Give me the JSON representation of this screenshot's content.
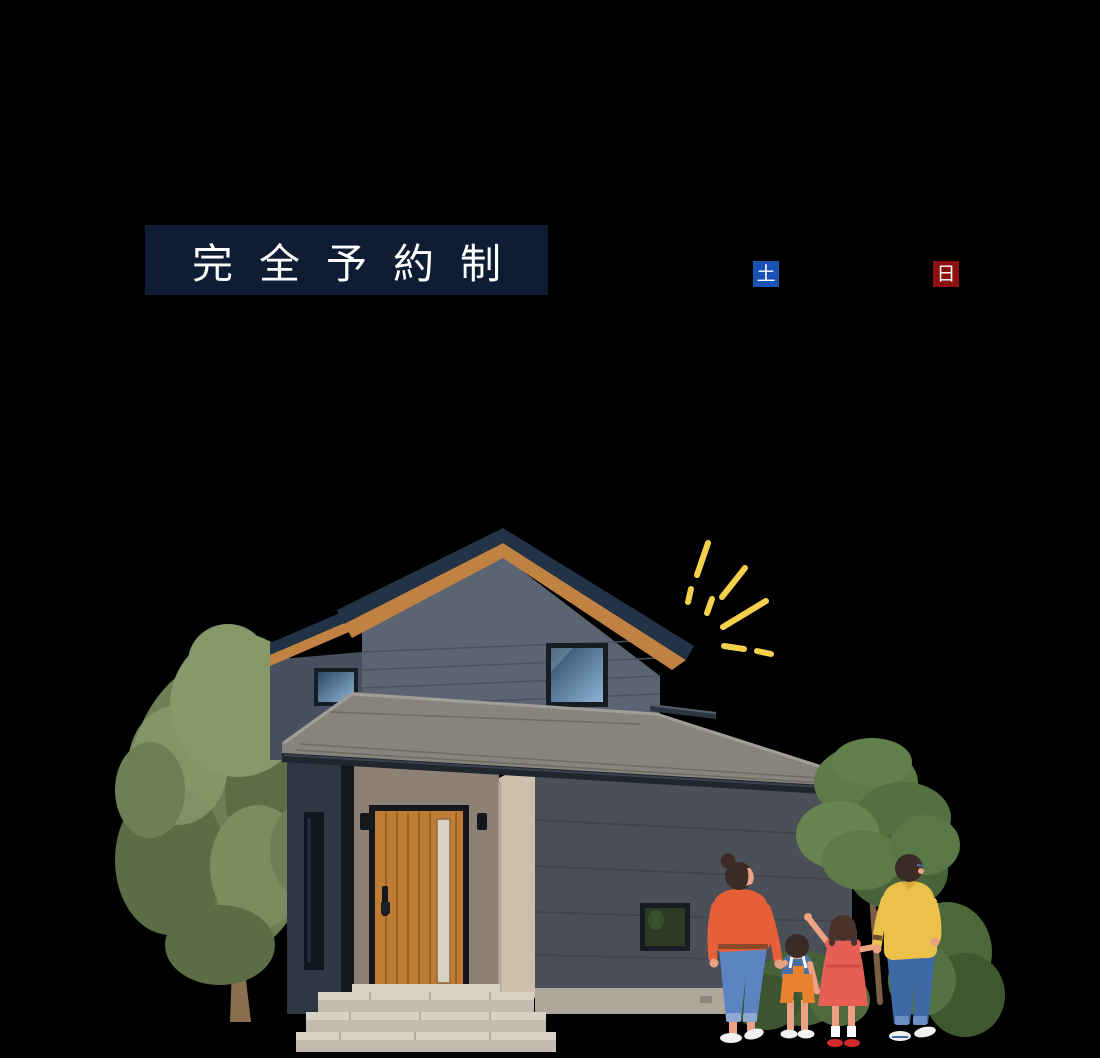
{
  "badges": {
    "reservation": {
      "label": "完全予約制"
    },
    "saturday": {
      "label": "土"
    },
    "sunday": {
      "label": "日"
    }
  },
  "illustration": {
    "icons": [
      "sparkle-icon",
      "house-illustration",
      "left-tree",
      "right-tree",
      "garden-bushes",
      "family-illustration"
    ]
  },
  "colors": {
    "page-bg": "#000000",
    "badge-navy": "#0e1d34",
    "badge-text": "#ffffff",
    "sat-blue": "#1a52b3",
    "sun-red": "#8c1010",
    "sparkle": "#f6d14e",
    "roof-navy": "#223247",
    "soffit-wood": "#c08243",
    "siding-lit": "#5a6473",
    "siding-line": "#49525f",
    "siding-wing": "#46505e",
    "siding-dark": "#2e3744",
    "shingle": "#87847d",
    "shingle-line": "#6e6b65",
    "shingle-hi": "#a19e97",
    "fascia": "#20262e",
    "wall-taupe": "#8d8176",
    "pillar-beige": "#cdbfac",
    "wall-front": "#4b5058",
    "wall-front-line": "#3f444b",
    "foundation": "#b0a79c",
    "door-frame": "#14181d",
    "door-wood": "#bf7c34",
    "door-plank": "#9a6120",
    "door-glass": "#d9d1c5",
    "window-frame": "#171c23",
    "glass-dark": "#2b4866",
    "glass-light": "#8fb4d6",
    "window-green": "#2b3a22",
    "step-top": "#d8d1c6",
    "step-face": "#c3bab0",
    "step-edge": "#a89f93",
    "tree-green": "#6e7f53",
    "tree-green-dark": "#5c6c44",
    "tree-green-light": "#87986b",
    "trunk": "#8a6e50",
    "branch": "#7b5f45",
    "bush-green": "#4c6839",
    "skin": "#eba184",
    "hair": "#3a2b27",
    "hair-brown": "#4a322c",
    "mom-top": "#e56038",
    "mom-jeans": "#5c84c2",
    "jeans-cuff": "#8fa9d4",
    "belt": "#8a4a28",
    "boy-shirt": "#4a70a8",
    "boy-overall": "#e8822f",
    "girl-dress": "#e55f55",
    "girl-shoes": "#cd2b2b",
    "dad-shirt": "#ecc14b",
    "dad-jeans": "#3f69a5",
    "shoe-white": "#f2f2f0"
  }
}
